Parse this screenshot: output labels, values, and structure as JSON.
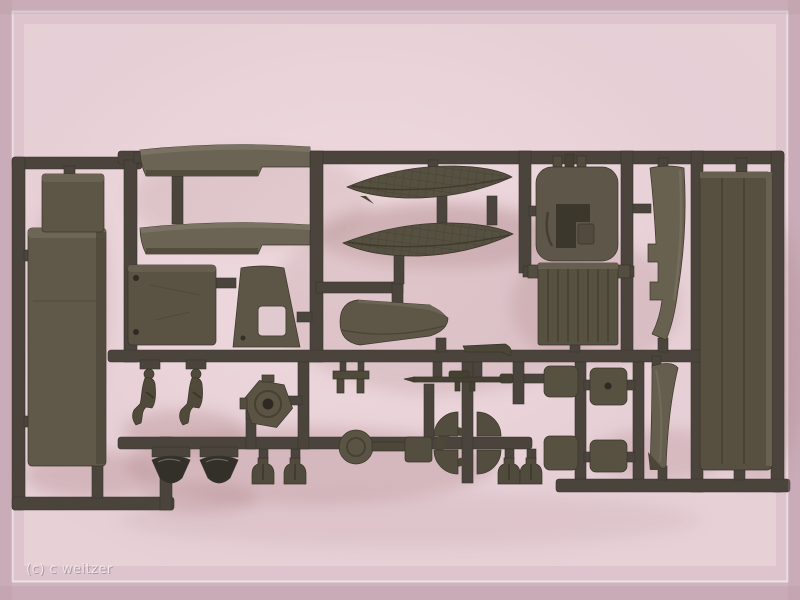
{
  "image_type": "photograph",
  "description": "Photo of an olive-drab injection-molded plastic model kit sprue (military truck parts) lying on a pale pink background with soft shadows and a thin white inner frame",
  "watermark": {
    "text": "(c) c weitzer",
    "color": "#ffffff",
    "opacity": 0.6
  },
  "palette": {
    "background_edge_pink": "#cfb4bf",
    "background_pink": "#ddc4cd",
    "background_inner_light": "#e9d3d9",
    "frame_line_white": "#ffffff",
    "shadow_tint": "#b08084",
    "runner_dark_olive": "#4a443c",
    "part_olive": "#5f584a",
    "part_olive_light": "#6e6759",
    "part_olive_dark": "#3b372d",
    "gloss_dark": "#33302a"
  },
  "parts_inventory": [
    {
      "id": "cargo-bed-floor",
      "label": "long rectangular truck bed part",
      "count": 1
    },
    {
      "id": "equipment-box",
      "label": "small rectangular box panel",
      "count": 1
    },
    {
      "id": "running-board",
      "label": "long curved running board / side rail",
      "count": 2
    },
    {
      "id": "door-panel",
      "label": "square door panel with hinge pins",
      "count": 1
    },
    {
      "id": "cab-side-panel",
      "label": "trapezoid cab side with window cutout",
      "count": 1
    },
    {
      "id": "pontoon-hull",
      "label": "leaf-shaped textured hull/cover part",
      "count": 2
    },
    {
      "id": "hood-wedge",
      "label": "rounded wedge engine hood part",
      "count": 1
    },
    {
      "id": "bulkhead-frame",
      "label": "rounded square bulkhead with cylinder studs",
      "count": 1
    },
    {
      "id": "radiator-grille",
      "label": "ribbed radiator panel",
      "count": 1
    },
    {
      "id": "windshield-pillar",
      "label": "stepped curved pillar strip",
      "count": 1
    },
    {
      "id": "roof-panel",
      "label": "large grooved roof/tarp panel",
      "count": 1
    },
    {
      "id": "seated-crew-figure",
      "label": "seated soldier figure",
      "count": 2
    },
    {
      "id": "spare-wheel-hex",
      "label": "hexagonal spare wheel hub",
      "count": 1
    },
    {
      "id": "headlight-dome",
      "label": "dark glossy dome lamp",
      "count": 2
    },
    {
      "id": "lamp-bracket",
      "label": "small bottle-shaped bracket",
      "count": 4
    },
    {
      "id": "wheel-disc",
      "label": "round disc with axle stub",
      "count": 1
    },
    {
      "id": "clamp-ring",
      "label": "open C-shaped clamp",
      "count": 1
    },
    {
      "id": "fender-corner",
      "label": "quarter-circle fender corner",
      "count": 4
    },
    {
      "id": "rifle",
      "label": "thin rifle/gun rod part",
      "count": 1
    },
    {
      "id": "tool-bracket",
      "label": "small H bracket",
      "count": 1
    },
    {
      "id": "seat-cushion",
      "label": "small rounded square cushion/seat part",
      "count": 4
    },
    {
      "id": "windshield-strip",
      "label": "narrow curved windshield strip",
      "count": 1
    }
  ]
}
